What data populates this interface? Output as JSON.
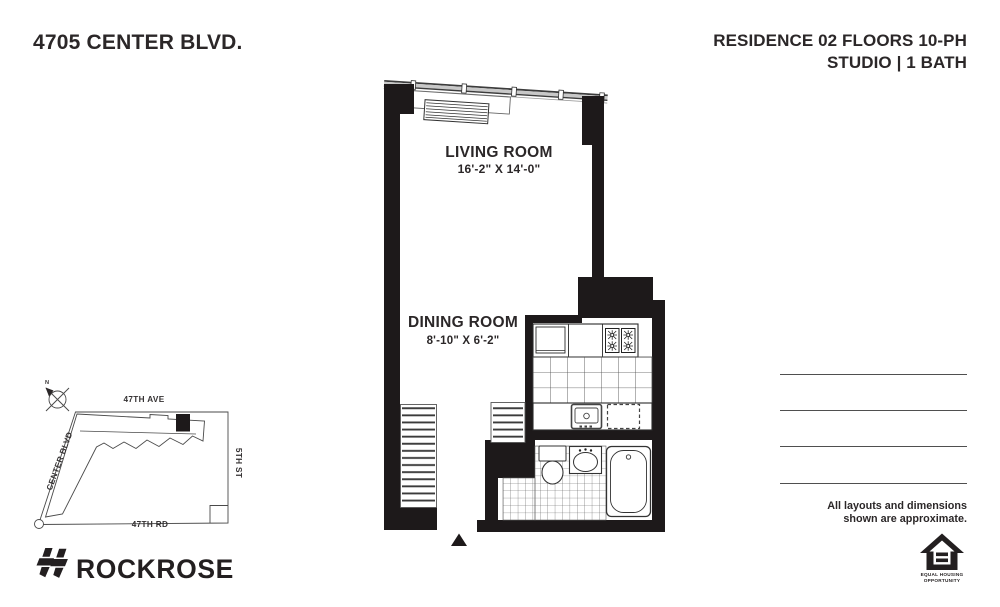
{
  "header": {
    "address": "4705 CENTER BLVD.",
    "residence": "RESIDENCE 02 FLOORS 10-PH",
    "unit_type": "STUDIO | 1 BATH"
  },
  "floor_plan": {
    "rooms": [
      {
        "name": "LIVING ROOM",
        "dimensions": "16'-2\" X 14'-0\""
      },
      {
        "name": "DINING ROOM",
        "dimensions": "8'-10\" X 6'-2\""
      }
    ],
    "fixture_icons": [
      "window-wall",
      "hvac-unit",
      "refrigerator",
      "stove-burners",
      "kitchen-sink",
      "dishwasher",
      "toilet",
      "bathroom-sink",
      "bathtub",
      "closet-shelves",
      "entry-marker"
    ]
  },
  "site_map": {
    "street_top": "47TH AVE",
    "street_left": "CENTER BLVD",
    "street_right": "5TH ST",
    "street_bottom": "47TH RD",
    "compass": "N"
  },
  "disclaimer": {
    "line1": "All layouts and dimensions",
    "line2": "shown are approximate."
  },
  "branding": {
    "name": "ROCKROSE"
  },
  "equal_housing": {
    "line1": "EQUAL HOUSING",
    "line2": "OPPORTUNITY"
  },
  "colors": {
    "ink": "#2b2728",
    "wall": "#1d191a",
    "note_line": "#4f4f4f"
  }
}
